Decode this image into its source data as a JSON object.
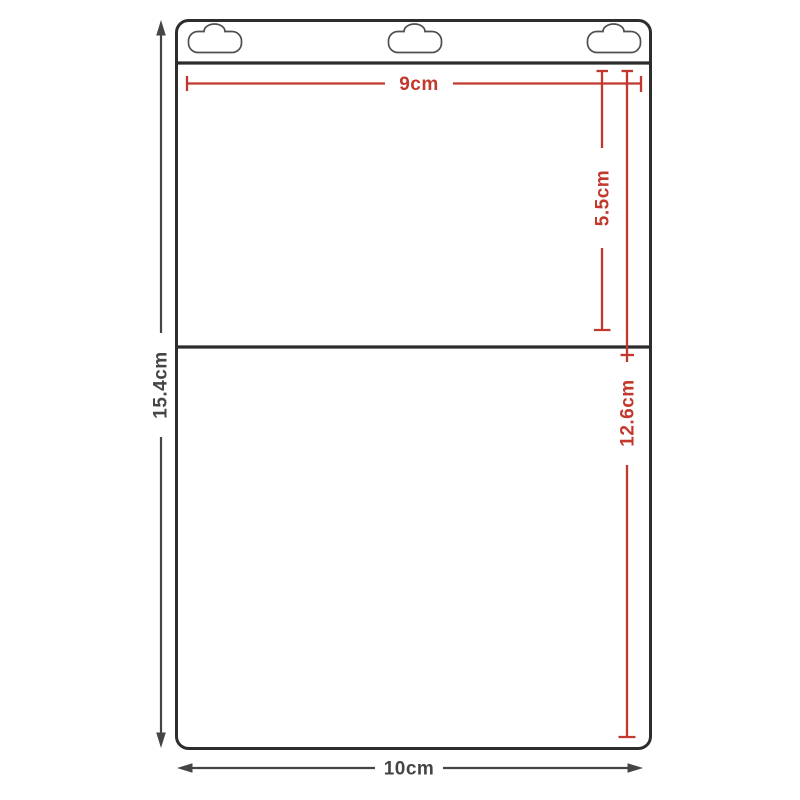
{
  "diagram": {
    "labels": {
      "overall_height": "15.4cm",
      "overall_width": "10cm",
      "top_opening_width": "9cm",
      "upper_pocket_height": "5.5cm",
      "lower_pocket_height": "12.6cm"
    },
    "colors": {
      "outline_color": "#2d2d2d",
      "accent_color": "#c2382c",
      "measure_color": "#454545",
      "tab_color": "#4f4f4f",
      "background_color": "#ffffff"
    }
  }
}
